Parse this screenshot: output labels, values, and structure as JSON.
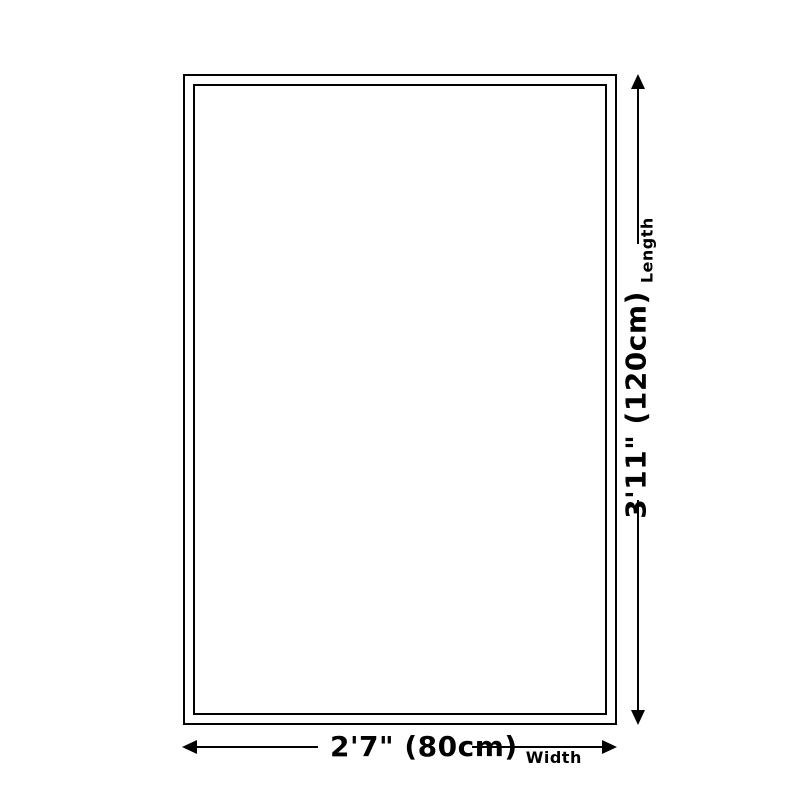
{
  "diagram": {
    "type": "product-size-diagram",
    "background_color": "#ffffff",
    "line_color": "#000000",
    "rug": {
      "border_color": "#000000",
      "fill_color": "#ffffff"
    },
    "length": {
      "value": "3'11\" (120cm)",
      "label": "Length"
    },
    "width": {
      "value": "2'7\" (80cm)",
      "label": "Width"
    }
  }
}
